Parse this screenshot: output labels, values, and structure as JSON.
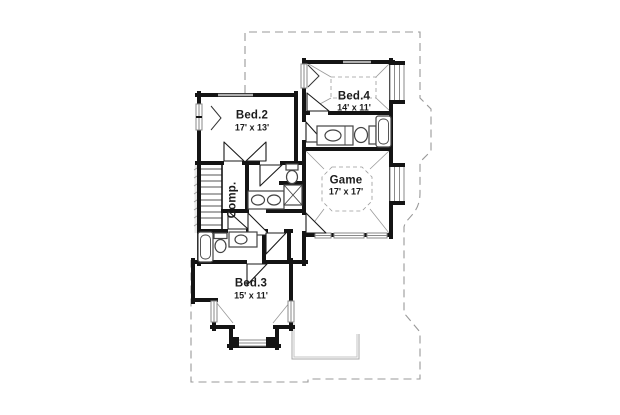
{
  "plan": {
    "rooms": {
      "bed2": {
        "name": "Bed.2",
        "dims": "17' x 13'"
      },
      "bed4": {
        "name": "Bed.4",
        "dims": "14' x 11'"
      },
      "game": {
        "name": "Game",
        "dims": "17' x 17'"
      },
      "bed3": {
        "name": "Bed.3",
        "dims": "15' x 11'"
      },
      "comp": {
        "name": "Comp."
      }
    },
    "colors": {
      "wall": "#141414",
      "roof_outline_dash": "#999999",
      "thin_detail": "#aaaaaa",
      "window_line": "#8a8a8a",
      "background": "#ffffff"
    }
  }
}
